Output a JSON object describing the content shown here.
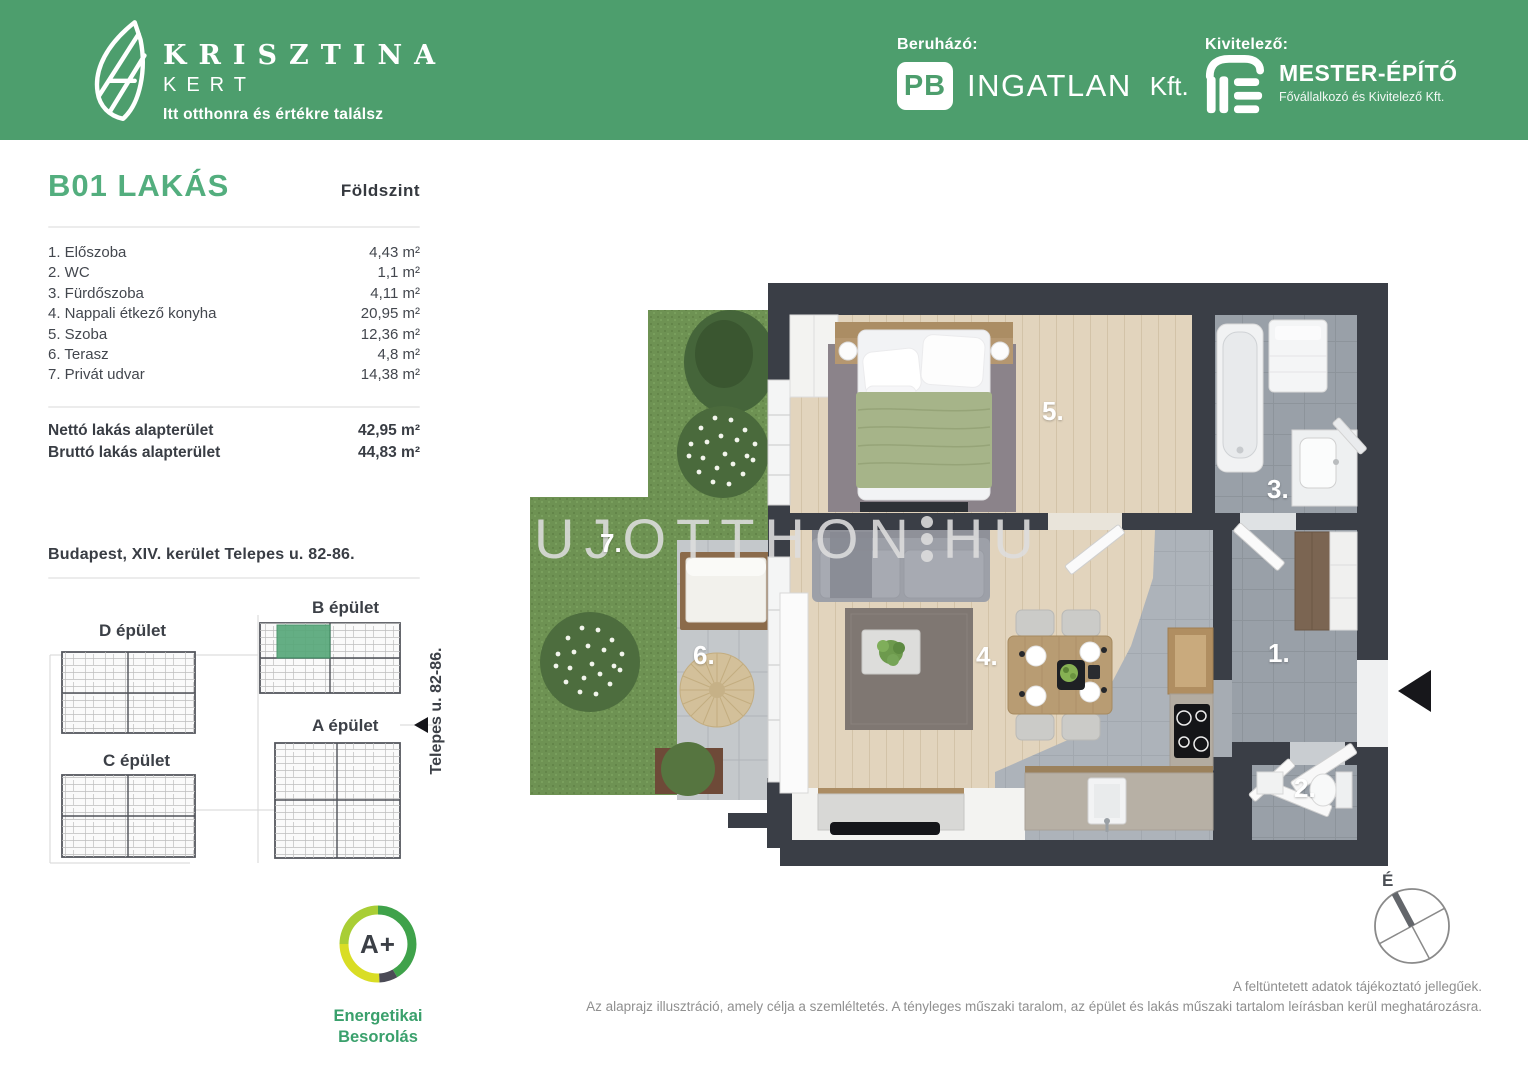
{
  "colors": {
    "header_green": "#4D9E6D",
    "title_green": "#53AE7E",
    "wall_dark": "#3A3E46",
    "energy_green": "#3AA06C",
    "highlight_unit_green": "#58A87A"
  },
  "header": {
    "brand": {
      "line1": "KRISZTINA",
      "line2": "KERT",
      "tagline": "Itt otthonra és értékre találsz"
    },
    "developer": {
      "label": "Beruházó:",
      "logo_monogram": "PB",
      "company": "INGATLAN",
      "suffix": "Kft."
    },
    "contractor": {
      "label": "Kivitelező:",
      "company": "MESTER-ÉPÍTŐ",
      "subtitle": "Fővállalkozó és Kivitelező Kft."
    }
  },
  "unit": {
    "title": "B01 LAKÁS",
    "floor_label": "Földszint",
    "rooms": [
      {
        "name": "1. Előszoba",
        "area": "4,43 m²"
      },
      {
        "name": "2. WC",
        "area": "1,1 m²"
      },
      {
        "name": "3. Fürdőszoba",
        "area": "4,11 m²"
      },
      {
        "name": "4. Nappali étkező konyha",
        "area": "20,95 m²"
      },
      {
        "name": "5. Szoba",
        "area": "12,36 m²"
      },
      {
        "name": "6. Terasz",
        "area": "4,8 m²"
      },
      {
        "name": "7. Privát udvar",
        "area": "14,38 m²"
      }
    ],
    "totals": [
      {
        "label": "Nettó lakás alapterület",
        "value": "42,95 m²"
      },
      {
        "label": "Bruttó lakás alapterület",
        "value": "44,83 m²"
      }
    ],
    "address": "Budapest, XIV. kerület Telepes u. 82-86."
  },
  "siteplan": {
    "buildings": [
      {
        "label": "B épület"
      },
      {
        "label": "D épület"
      },
      {
        "label": "A épület"
      },
      {
        "label": "C épület"
      }
    ],
    "street": "Telepes u. 82-86."
  },
  "energy": {
    "rating": "A+",
    "label1": "Energetikai",
    "label2": "Besorolás"
  },
  "floorplan": {
    "watermark_left": "UJOTTHON",
    "watermark_right": "HU",
    "labels": {
      "r1": "1.",
      "r2": "2.",
      "r3": "3.",
      "r4": "4.",
      "r5": "5.",
      "r6": "6.",
      "r7": "7."
    },
    "compass_north": "É"
  },
  "footer": {
    "line1": "A feltüntetett adatok tájékoztató jellegűek.",
    "line2": "Az alaprajz illusztráció, amely célja a szemléltetés. A tényleges műszaki taralom, az épület és lakás műszaki tartalom leírásban kerül meghatározásra."
  }
}
